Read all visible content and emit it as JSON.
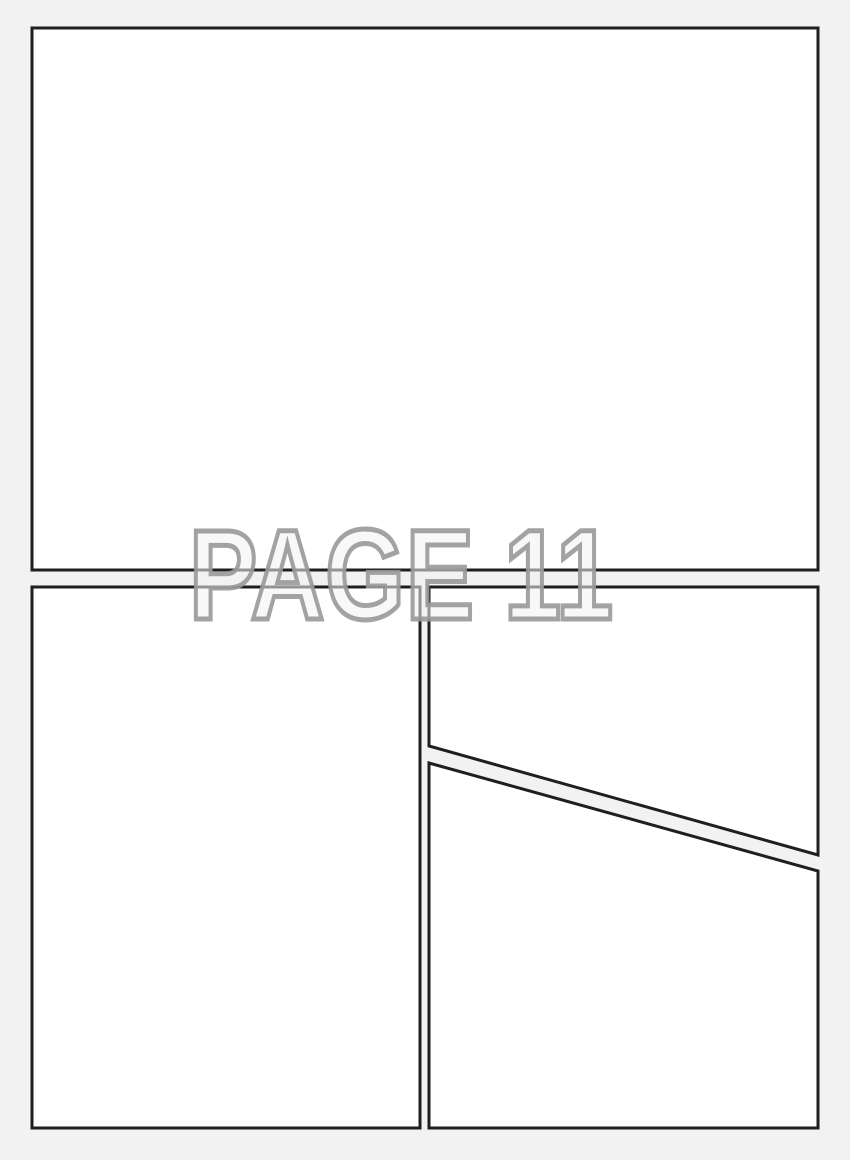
{
  "page": {
    "label": "PAGE 11",
    "panel_count": 4,
    "colors": {
      "background": "#f2f2f2",
      "panel_fill": "#ffffff",
      "panel_border": "#1f1f1f",
      "label_outline": "#999999",
      "label_fill": "#f2f2f2"
    }
  },
  "panels": [
    {
      "id": "panel-top",
      "position": "top",
      "shape": "rectangle"
    },
    {
      "id": "panel-bottom-left",
      "position": "bottom-left",
      "shape": "rectangle"
    },
    {
      "id": "panel-middle-right",
      "position": "middle-right",
      "shape": "quad-with-diagonal-bottom-edge"
    },
    {
      "id": "panel-bottom-right",
      "position": "bottom-right",
      "shape": "quad-with-diagonal-top-edge"
    }
  ]
}
